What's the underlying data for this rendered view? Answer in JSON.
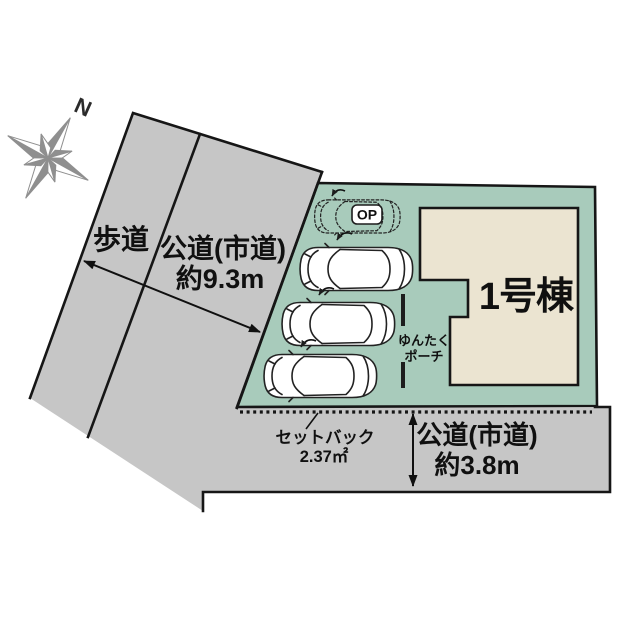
{
  "compass": {
    "label": "N"
  },
  "sidewalk": {
    "label": "歩道"
  },
  "road_west": {
    "name": "公道(市道)",
    "width": "約9.3m"
  },
  "road_south": {
    "name": "公道(市道)",
    "width": "約3.8m"
  },
  "building": {
    "label": "1号棟"
  },
  "porch": {
    "line1": "ゆんたく",
    "line2": "ポーチ"
  },
  "parking": {
    "total_spaces": 4,
    "solid_cars": 3,
    "dashed_cars": 1,
    "optional_label": "OP"
  },
  "setback": {
    "label": "セットバック",
    "area": "2.37㎡"
  },
  "colors": {
    "road_gray": "#c6c6c6",
    "lot_green": "#a8cbbb",
    "building_beige": "#ebe4d1",
    "outline": "#161616",
    "compass_gray": "#8f8f8f"
  }
}
